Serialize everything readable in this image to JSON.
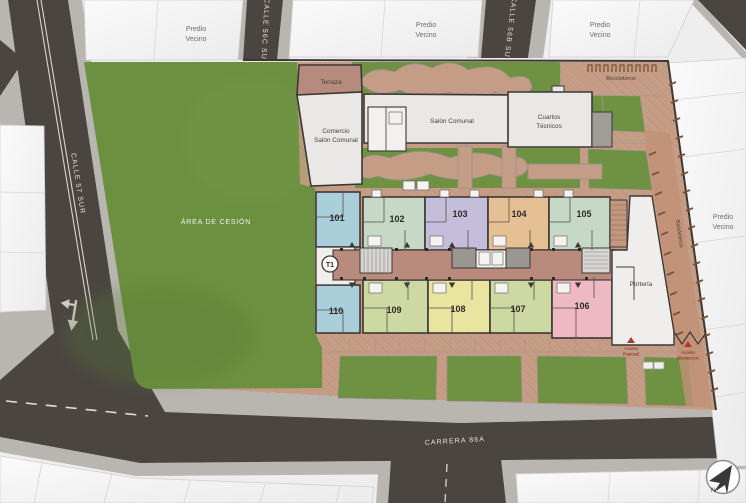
{
  "streets": {
    "calle_57_sur": "CALLE 57 SUR",
    "calle_56c_sur": "CALLE 56C SUR",
    "calle_56b_sur": "CALLE 56B SUR",
    "carrera_86a": "CARRERA 86A"
  },
  "areas": {
    "area_cesion": "ÁREA DE CESIÓN",
    "terraza": "Terraza",
    "comercio_line1": "Comercio",
    "comercio_line2": "Salón Comunal",
    "salon_comunal": "Salón Comunal",
    "cuartos_line1": "Cuartos",
    "cuartos_line2": "Técnicos",
    "porteria": "Portería",
    "bicicleteros": "Bicicleteros",
    "predio_line1": "Predio",
    "predio_line2": "Vecino"
  },
  "tower_label": "T1",
  "access": {
    "peatonal_line1": "Acceso",
    "peatonal_line2": "Peatonal",
    "bicicleteros_line1": "Acceso",
    "bicicleteros_line2": "Bicicleteros"
  },
  "compass_north": "N",
  "units": [
    {
      "number": "101",
      "color": "#abcfda"
    },
    {
      "number": "102",
      "color": "#c6d9c6"
    },
    {
      "number": "103",
      "color": "#c4bedb"
    },
    {
      "number": "104",
      "color": "#e5c095"
    },
    {
      "number": "105",
      "color": "#c6d9c6"
    },
    {
      "number": "106",
      "color": "#efb9c3"
    },
    {
      "number": "107",
      "color": "#cdd8a3"
    },
    {
      "number": "108",
      "color": "#e9e5a0"
    },
    {
      "number": "109",
      "color": "#cdd8a3"
    },
    {
      "number": "110",
      "color": "#abcfda"
    }
  ],
  "palette": {
    "street": "#4b4542",
    "sidewalk": "#b9b6b1",
    "grass": "#6b9040",
    "lawn": "#6f9242",
    "plaza": "#c69d86",
    "corridor": "#b98b7d",
    "lobby": "#f0efed",
    "amenity": "#eae8e6",
    "terraza": "#b68a7c",
    "access_red": "#b03a2a"
  }
}
